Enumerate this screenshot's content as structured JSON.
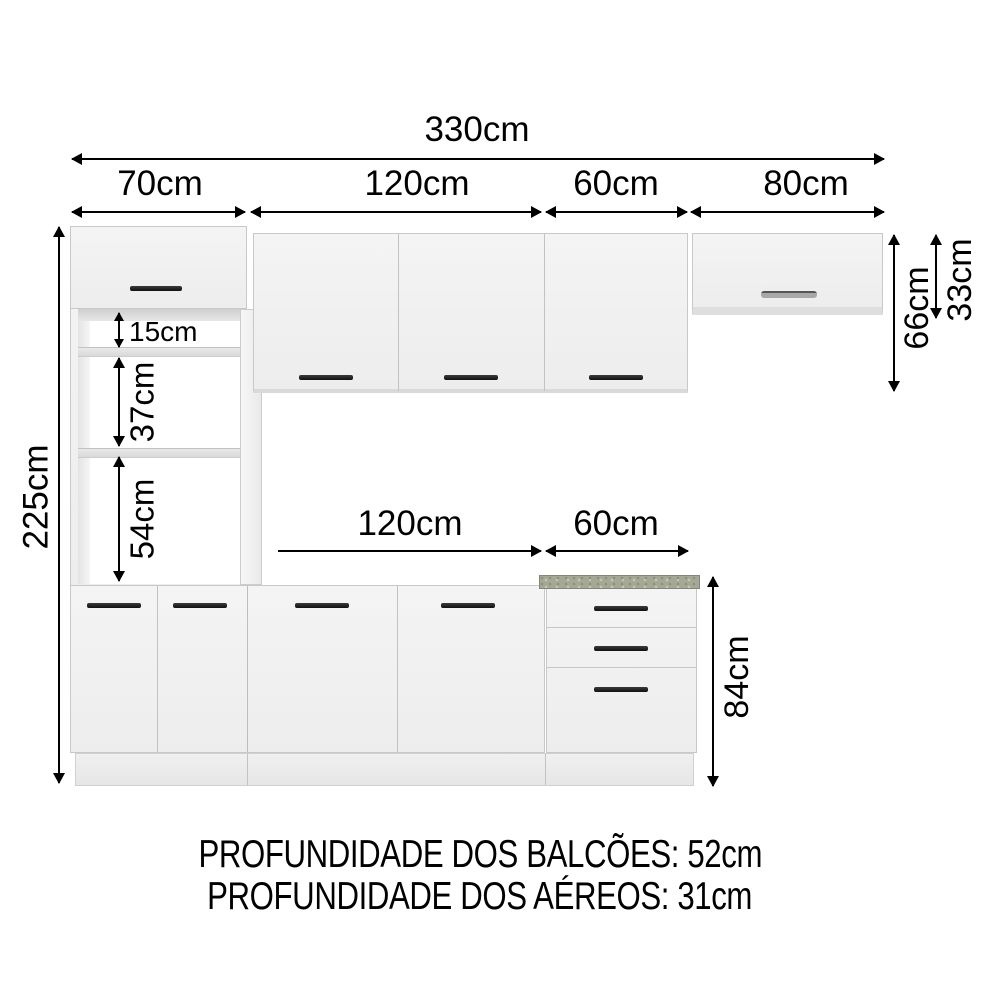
{
  "dimensions": {
    "total_width": "330cm",
    "total_height": "225cm",
    "upper_widths": {
      "tower": "70cm",
      "aereo_120": "120cm",
      "aereo_60": "60cm",
      "aereo_80": "80cm"
    },
    "tower_niches": {
      "niche_top": "15cm",
      "niche_middle": "37cm",
      "niche_bottom": "54cm"
    },
    "upper_heights": {
      "aereo_total": "66cm",
      "aereo_80_height": "33cm"
    },
    "base_widths": {
      "balcao_120": "120cm",
      "balcao_60": "60cm"
    },
    "base_height": "84cm"
  },
  "footer": {
    "balcoes_depth": "PROFUNDIDADE DOS BALCÕES: 52cm",
    "aereos_depth": "PROFUNDIDADE DOS AÉREOS: 31cm"
  },
  "colors": {
    "background": "#ffffff",
    "cabinet_face": "#f2f2f2",
    "cabinet_border": "#c8c8c8",
    "handle_dark": "#1f1f1f",
    "handle_silver": "#a8a8a8",
    "countertop": "#a6a896",
    "dimension_lines": "#000000"
  }
}
